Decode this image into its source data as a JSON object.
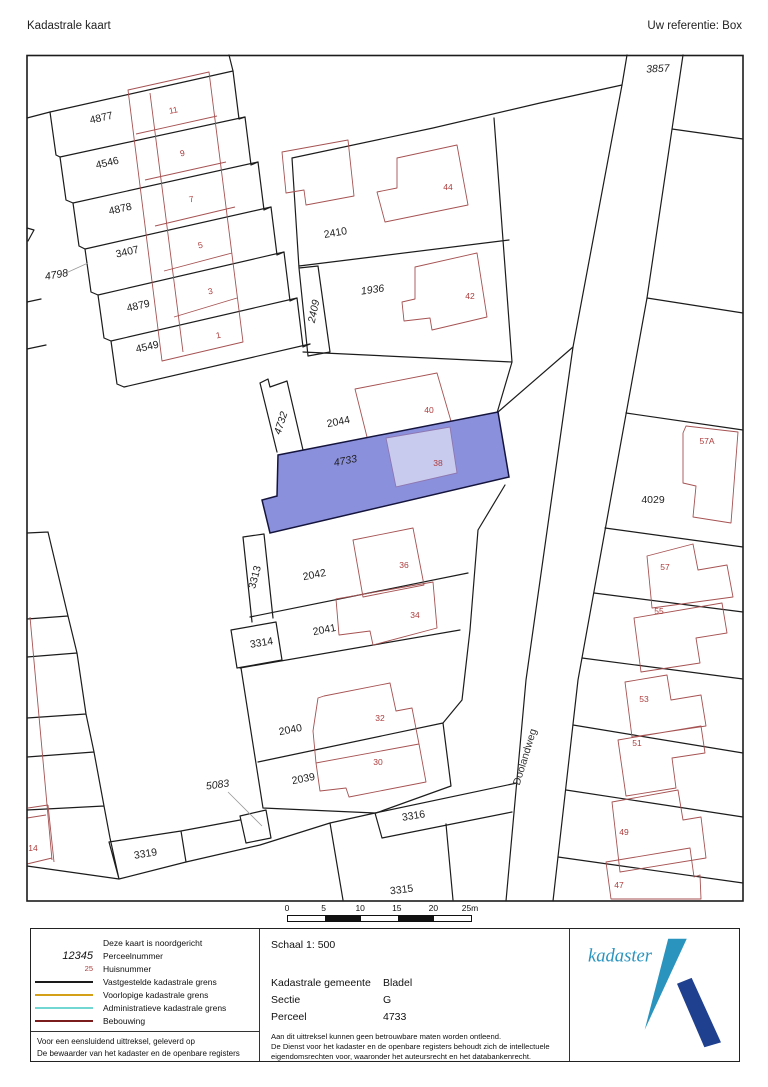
{
  "header": {
    "title": "Kadastrale kaart",
    "reference": "Uw referentie: Box"
  },
  "map": {
    "street_label": {
      "text": "Doolandweg",
      "x": 528,
      "y": 758,
      "rot": -73
    },
    "highlight": {
      "parcel": "4733",
      "fill": "#8b90dd",
      "building_fill": "#c9cbee"
    },
    "parcel_labels": [
      {
        "text": "4877",
        "x": 102,
        "y": 121,
        "rot": -13
      },
      {
        "text": "4546",
        "x": 108,
        "y": 166,
        "rot": -13
      },
      {
        "text": "4878",
        "x": 121,
        "y": 212,
        "rot": -13
      },
      {
        "text": "3407",
        "x": 128,
        "y": 255,
        "rot": -13
      },
      {
        "text": "4798",
        "x": 57,
        "y": 278,
        "rot": -10,
        "italic": true
      },
      {
        "text": "4879",
        "x": 139,
        "y": 309,
        "rot": -13
      },
      {
        "text": "4549",
        "x": 148,
        "y": 350,
        "rot": -13
      },
      {
        "text": "2410",
        "x": 336,
        "y": 236,
        "rot": -10
      },
      {
        "text": "1936",
        "x": 373,
        "y": 293,
        "rot": -8,
        "italic": true
      },
      {
        "text": "2409",
        "x": 317,
        "y": 312,
        "rot": -78,
        "italic": true
      },
      {
        "text": "4732",
        "x": 284,
        "y": 424,
        "rot": -72,
        "italic": true
      },
      {
        "text": "2044",
        "x": 339,
        "y": 425,
        "rot": -11
      },
      {
        "text": "4733",
        "x": 346,
        "y": 464,
        "rot": -11,
        "italic": true
      },
      {
        "text": "3313",
        "x": 258,
        "y": 578,
        "rot": -75
      },
      {
        "text": "2042",
        "x": 315,
        "y": 578,
        "rot": -11
      },
      {
        "text": "2041",
        "x": 325,
        "y": 633,
        "rot": -11
      },
      {
        "text": "3314",
        "x": 262,
        "y": 646,
        "rot": -9
      },
      {
        "text": "2040",
        "x": 291,
        "y": 733,
        "rot": -11
      },
      {
        "text": "2039",
        "x": 304,
        "y": 782,
        "rot": -11
      },
      {
        "text": "5083",
        "x": 218,
        "y": 788,
        "rot": -8,
        "italic": true
      },
      {
        "text": "3316",
        "x": 414,
        "y": 819,
        "rot": -9
      },
      {
        "text": "3319",
        "x": 146,
        "y": 857,
        "rot": -9
      },
      {
        "text": "3315",
        "x": 402,
        "y": 893,
        "rot": -7
      },
      {
        "text": "3857",
        "x": 658,
        "y": 72,
        "rot": -3,
        "italic": true
      },
      {
        "text": "4029",
        "x": 653,
        "y": 503,
        "rot": 0
      }
    ],
    "house_numbers": [
      {
        "text": "11",
        "x": 174,
        "y": 113,
        "rot": -12
      },
      {
        "text": "9",
        "x": 183,
        "y": 156,
        "rot": -12
      },
      {
        "text": "7",
        "x": 192,
        "y": 202,
        "rot": -12
      },
      {
        "text": "5",
        "x": 201,
        "y": 248,
        "rot": -12
      },
      {
        "text": "3",
        "x": 211,
        "y": 294,
        "rot": -12
      },
      {
        "text": "1",
        "x": 219,
        "y": 338,
        "rot": -12
      },
      {
        "text": "44",
        "x": 448,
        "y": 190
      },
      {
        "text": "42",
        "x": 470,
        "y": 299
      },
      {
        "text": "40",
        "x": 429,
        "y": 413
      },
      {
        "text": "38",
        "x": 438,
        "y": 466
      },
      {
        "text": "36",
        "x": 404,
        "y": 568
      },
      {
        "text": "34",
        "x": 415,
        "y": 618
      },
      {
        "text": "32",
        "x": 380,
        "y": 721
      },
      {
        "text": "30",
        "x": 378,
        "y": 765
      },
      {
        "text": "14",
        "x": 33,
        "y": 851
      },
      {
        "text": "57A",
        "x": 707,
        "y": 444
      },
      {
        "text": "57",
        "x": 665,
        "y": 570
      },
      {
        "text": "55",
        "x": 659,
        "y": 614
      },
      {
        "text": "53",
        "x": 644,
        "y": 702
      },
      {
        "text": "51",
        "x": 637,
        "y": 746
      },
      {
        "text": "49",
        "x": 624,
        "y": 835
      },
      {
        "text": "47",
        "x": 619,
        "y": 888
      }
    ]
  },
  "scalebar": {
    "ticks": [
      "0",
      "5",
      "10",
      "15",
      "20",
      "25m"
    ]
  },
  "legend": {
    "north_note": "Deze kaart is noordgericht",
    "parcel_sample": "12345",
    "parcel_label": "Perceelnummer",
    "house_sample": "25",
    "house_label": "Huisnummer",
    "line_items": [
      {
        "label": "Vastgestelde kadastrale grens",
        "color": "#1a1a1a"
      },
      {
        "label": "Voorlopige kadastrale grens",
        "color": "#d4a017"
      },
      {
        "label": "Administratieve kadastrale grens",
        "color": "#72d6d2"
      },
      {
        "label": "Bebouwing",
        "color": "#7b1c1c"
      }
    ],
    "footer_line1": "Voor een eensluidend uittreksel, geleverd op",
    "footer_line2": "De bewaarder van het kadaster en de openbare registers"
  },
  "info": {
    "schaal": "Schaal 1: 500",
    "rows": [
      {
        "label": "Kadastrale gemeente",
        "value": "Bladel"
      },
      {
        "label": "Sectie",
        "value": "G"
      },
      {
        "label": "Perceel",
        "value": "4733"
      }
    ],
    "disclaimer1": "Aan dit uittreksel kunnen geen betrouwbare maten worden ontleend.",
    "disclaimer2": "De Dienst voor het kadaster en de openbare registers behoudt zich de intellectuele",
    "disclaimer3": "eigendomsrechten voor, waaronder het auteursrecht en het databankenrecht."
  },
  "logo": {
    "text": "kadaster",
    "teal": "#2a94bf",
    "dark": "#1f3f8f"
  }
}
